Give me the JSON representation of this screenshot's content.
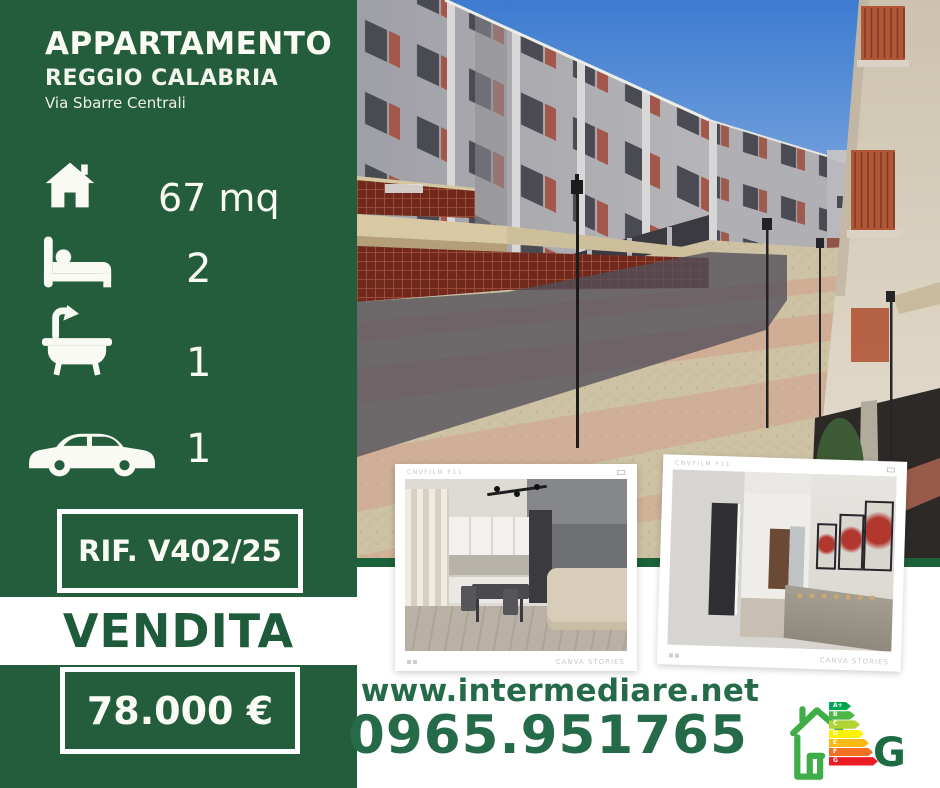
{
  "listing": {
    "property_type": "APPARTAMENTO",
    "city": "REGGIO CALABRIA",
    "street": "Via Sbarre Centrali",
    "transaction": "VENDITA",
    "price": "78.000 €",
    "reference": "RIF. V402/25"
  },
  "features": [
    {
      "icon": "house-icon",
      "value": "67 mq"
    },
    {
      "icon": "bed-icon",
      "value": "2"
    },
    {
      "icon": "bathtub-icon",
      "value": "1"
    },
    {
      "icon": "car-icon",
      "value": "1"
    }
  ],
  "contact": {
    "website": "www.intermediare.net",
    "phone": "0965.951765"
  },
  "energy": {
    "rating": "G",
    "classes": [
      {
        "label": "A+",
        "color": "#00A651"
      },
      {
        "label": "B",
        "color": "#4DB848"
      },
      {
        "label": "C",
        "color": "#B2D235"
      },
      {
        "label": "D",
        "color": "#FFF200"
      },
      {
        "label": "E",
        "color": "#FDB913"
      },
      {
        "label": "F",
        "color": "#F37021"
      },
      {
        "label": "G",
        "color": "#ED1C24"
      }
    ]
  },
  "photo_frames": {
    "camera_label": "CNVFILM F11",
    "brand_label": "CANVA STORIES"
  },
  "colors": {
    "sidebar_green": "#245D3C",
    "text_green": "#1E5B3B",
    "contact_green": "#266B49",
    "divider_green": "#1B6139",
    "energy_house_green": "#3FAE49"
  }
}
